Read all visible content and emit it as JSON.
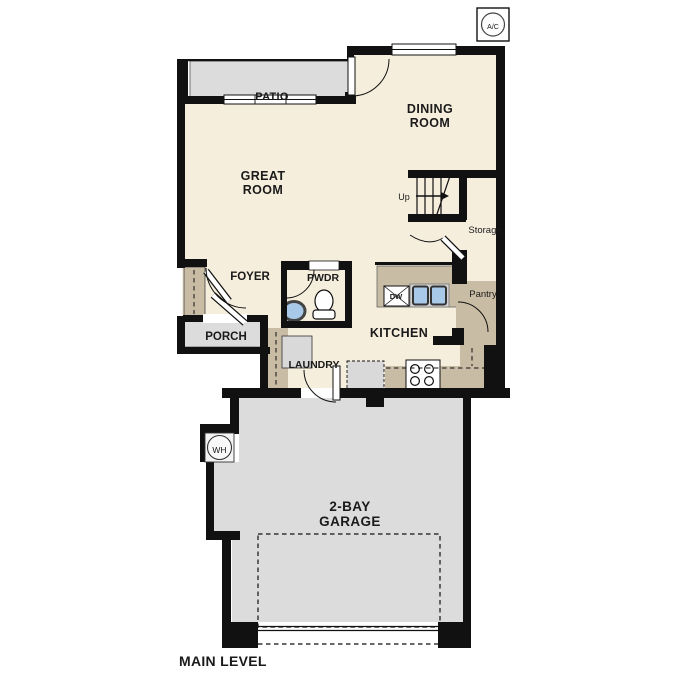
{
  "title": "Main level floor plan",
  "labels": {
    "ac": "A/C",
    "patio": "PATIO",
    "dining_line1": "DINING",
    "dining_line2": "ROOM",
    "great_line1": "GREAT",
    "great_line2": "ROOM",
    "up": "Up",
    "storage": "Storage",
    "pantry": "Pantry",
    "dw": "DW",
    "kitchen": "KITCHEN",
    "foyer": "FOYER",
    "pwdr": "PWDR",
    "porch": "PORCH",
    "laundry": "LAUNDRY",
    "wh": "WH",
    "garage_line1": "2-BAY",
    "garage_line2": "GARAGE",
    "main_level": "MAIN LEVEL"
  },
  "colors": {
    "wall": "#111111",
    "floor": "#f6eedd",
    "hard_surface": "#dcdcdc",
    "counter": "#c9bca4",
    "sink": "#a9c9e8",
    "background": "#ffffff"
  }
}
